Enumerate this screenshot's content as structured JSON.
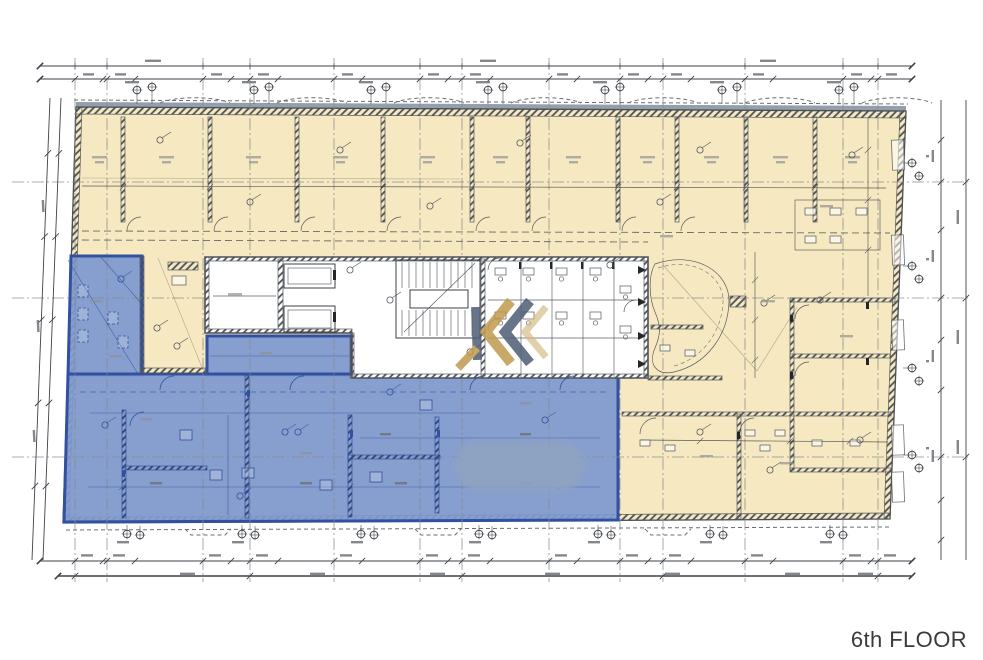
{
  "floor_label": "6th FLOOR",
  "colors": {
    "paper": "#FFFFFF",
    "zone_yellow": "#F6E8C0",
    "zone_blue": "#7E99CF",
    "zone_blue_border": "#31509F",
    "wall_gray": "#4A4F55",
    "line": "#3E4248",
    "grid_line": "#85888C",
    "top_band_gray": "#8E9AA6",
    "watermark_gold": "#C09A4E",
    "watermark_slate": "#4E5D75",
    "watermark_tan": "#D3BC85",
    "blur_blob": "#8FA3C2",
    "smudge": "#6F7377",
    "label_text": "#3A3A3A"
  },
  "icons": {
    "watermark": "k-monogram-watermark",
    "survey_marker": "circle-cross-marker"
  }
}
